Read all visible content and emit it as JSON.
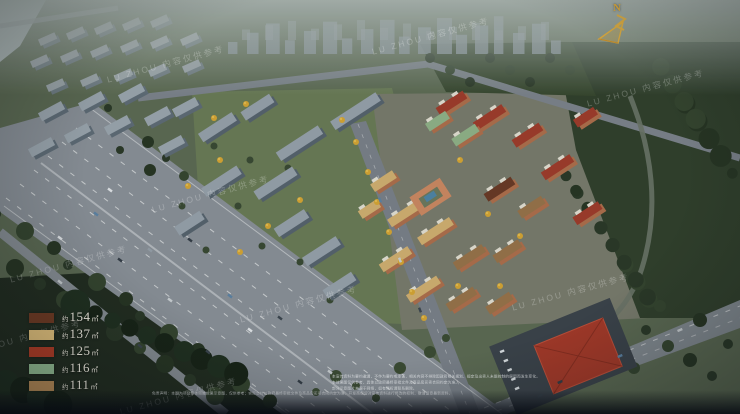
{
  "watermark": {
    "text": "LU ZHOU 内容仅供参考"
  },
  "compass": {
    "label": "N",
    "color": "#d2a43e"
  },
  "legend": {
    "items": [
      {
        "prefix": "约",
        "area": "154",
        "unit": "㎡",
        "color": "#6e3a23"
      },
      {
        "prefix": "约",
        "area": "137",
        "unit": "㎡",
        "color": "#e2c17c"
      },
      {
        "prefix": "约",
        "area": "125",
        "unit": "㎡",
        "color": "#b23d26"
      },
      {
        "prefix": "约",
        "area": "116",
        "unit": "㎡",
        "color": "#95c095"
      },
      {
        "prefix": "约",
        "area": "111",
        "unit": "㎡",
        "color": "#ba8e58"
      }
    ]
  },
  "disclaimer": {
    "lines": [
      "本宣传资料为要约邀请，不作为要约或承诺，相关内容不排除因政府相关规划、规定及出卖人未能控制的原因而发生变化。",
      "本效果图仅供参考，具体以政府最终审批文件及商品房买卖合同约定为准。",
      "部分示意图片来源于网络，如有侵权请联系删除。",
      "免责声明：本图为项目整体鸟瞰效果示意图，仅供参考；实际交付以政府最终审批文件及商品房买卖合同约定为准，开发商保留对宣传资料进行修改的权利，敬请留意最新资料。"
    ]
  }
}
